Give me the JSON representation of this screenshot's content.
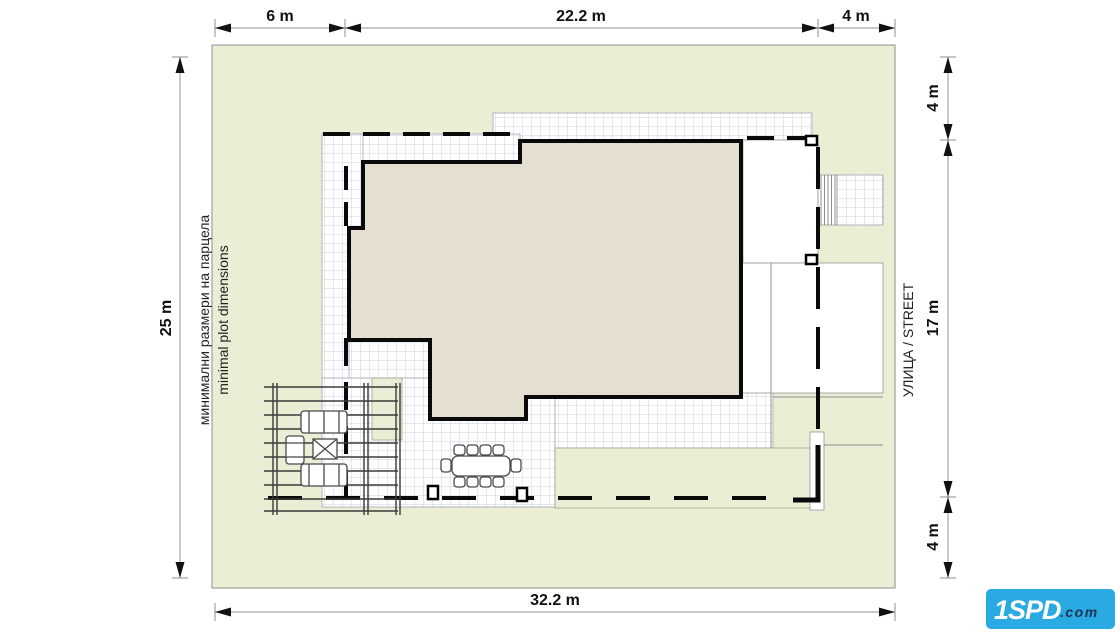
{
  "dimensions": {
    "top": [
      "6 m",
      "22.2 m",
      "4 m"
    ],
    "left": "25 m",
    "bottom": "32.2 m",
    "right_top": "4 m",
    "right_middle": "17 m",
    "right_bottom": "4 m"
  },
  "labels": {
    "plot_note_bg": "минимални размери на парцела",
    "plot_note_en": "minimal plot dimensions",
    "street": "УЛИЦА / STREET"
  },
  "logo": {
    "text": "1SPD",
    "suffix": ".com"
  },
  "colors": {
    "plot_green": "#ebeed5",
    "house_fill": "#e5dfd1",
    "wall_black": "#0a0a0a",
    "grid_line": "#c9d2e0",
    "logo_blue": "#29aae2"
  }
}
